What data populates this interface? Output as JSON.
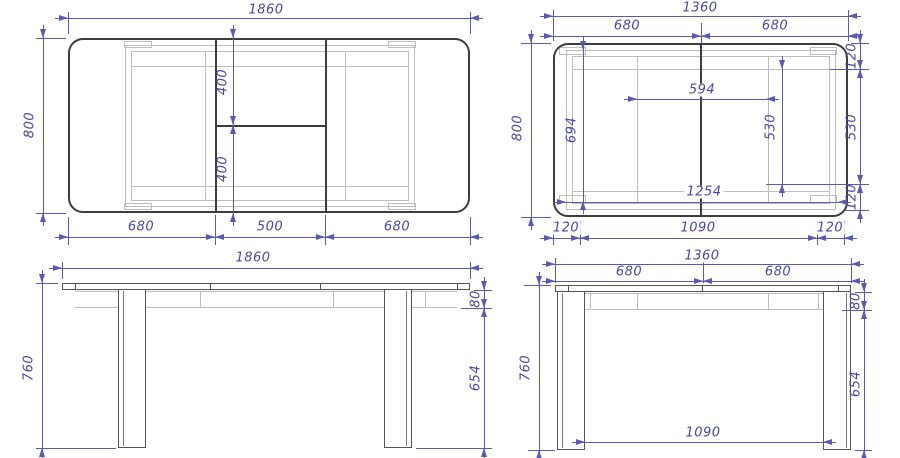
{
  "colors": {
    "dimension": "#5a5ab2",
    "dimension_text": "#4747a8",
    "outline": "#3d3d3d",
    "secondary": "#555555",
    "thin": "#777777",
    "hidden": "#bdbdbd",
    "background": "#ffffff"
  },
  "views": {
    "top_extended": {
      "dims": {
        "width": "1860",
        "depth": "800",
        "leaf_left": "680",
        "insert": "500",
        "leaf_right": "680",
        "insert_back": "400",
        "insert_front": "400"
      }
    },
    "top_compact": {
      "dims": {
        "width": "1360",
        "half_left": "680",
        "half_right": "680",
        "depth": "800",
        "rail_span": "594",
        "frame_depth": "694",
        "rail_depth": "530",
        "side_inset_top": "120",
        "side_rail": "530",
        "side_inset_bottom": "120",
        "frame_length": "1254",
        "front_inset_left": "120",
        "leg_span": "1090",
        "front_inset_right": "120"
      }
    },
    "side_extended": {
      "dims": {
        "width": "1860",
        "height": "760",
        "apron": "80",
        "leg_clearance": "654"
      }
    },
    "side_compact": {
      "dims": {
        "width": "1360",
        "half_left": "680",
        "half_right": "680",
        "height": "760",
        "apron": "80",
        "leg_clearance": "654",
        "leg_span": "1090"
      }
    }
  }
}
